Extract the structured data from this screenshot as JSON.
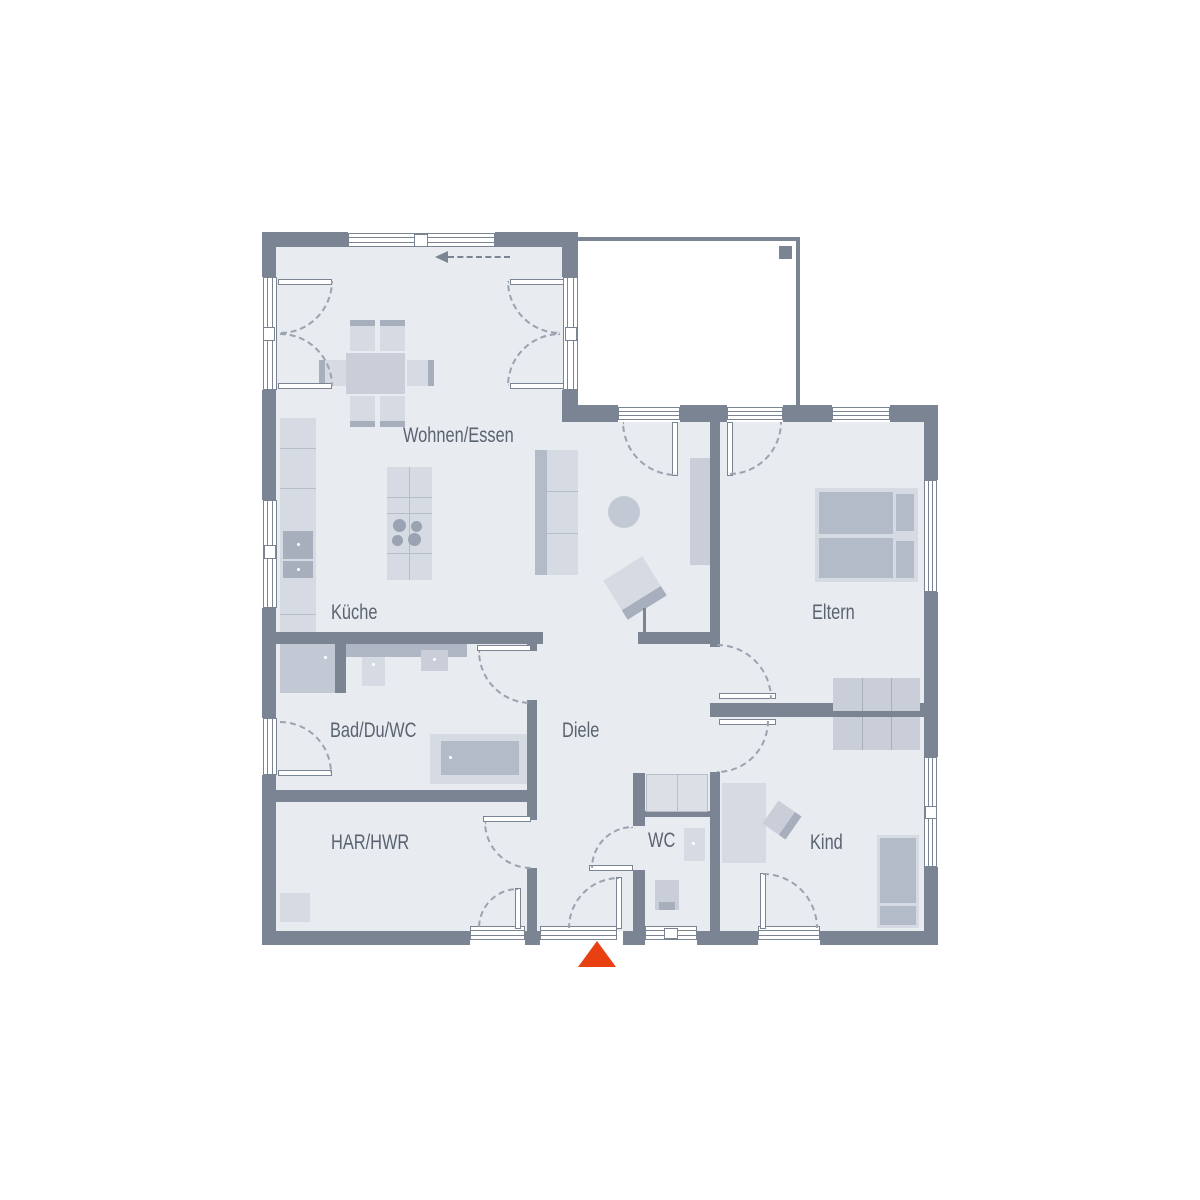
{
  "floorplan": {
    "rooms": [
      {
        "id": "wohnen-essen",
        "label": "Wohnen/Essen"
      },
      {
        "id": "kueche",
        "label": "Küche"
      },
      {
        "id": "eltern",
        "label": "Eltern"
      },
      {
        "id": "bad-du-wc",
        "label": "Bad/Du/WC"
      },
      {
        "id": "diele",
        "label": "Diele"
      },
      {
        "id": "wc",
        "label": "WC"
      },
      {
        "id": "har-hwr",
        "label": "HAR/HWR"
      },
      {
        "id": "kind",
        "label": "Kind"
      }
    ],
    "icons": {
      "entrance_marker": "entrance-triangle-icon",
      "sliding_door_arrow": "arrow-left-icon"
    },
    "colors": {
      "wall": "#7b8492",
      "room_fill": "#e8ebf0",
      "furniture_light": "#d6dae2",
      "furniture_mid": "#c9ced9",
      "furniture_dark": "#a7afbd",
      "entrance_marker": "#e84010",
      "label_text": "#5a6370"
    }
  }
}
